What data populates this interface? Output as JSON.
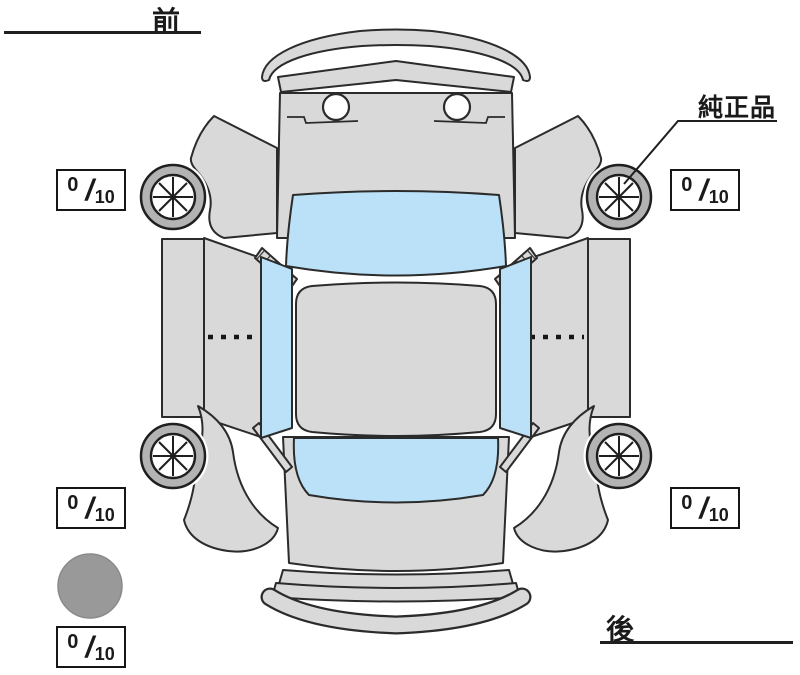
{
  "diagram": {
    "orientation_labels": {
      "front": "前",
      "rear": "後"
    },
    "annotation": {
      "genuine_part": "純正品"
    },
    "tire_scores": {
      "front_left": {
        "value": "0",
        "separator": "/",
        "max": "10"
      },
      "front_right": {
        "value": "0",
        "separator": "/",
        "max": "10"
      },
      "rear_left": {
        "value": "0",
        "separator": "/",
        "max": "10"
      },
      "rear_right": {
        "value": "0",
        "separator": "/",
        "max": "10"
      },
      "bottom_left": {
        "value": "0",
        "separator": "/",
        "max": "10"
      }
    },
    "colors": {
      "body": "#d9d9d9",
      "glass": "#bae1f7",
      "outline": "#2b2b2b",
      "tire": "#b3b3b3",
      "marker_circle": "#999999",
      "background": "#ffffff"
    },
    "icons": {
      "wheel": "wheel-icon",
      "marker": "gray-circle-marker"
    }
  }
}
